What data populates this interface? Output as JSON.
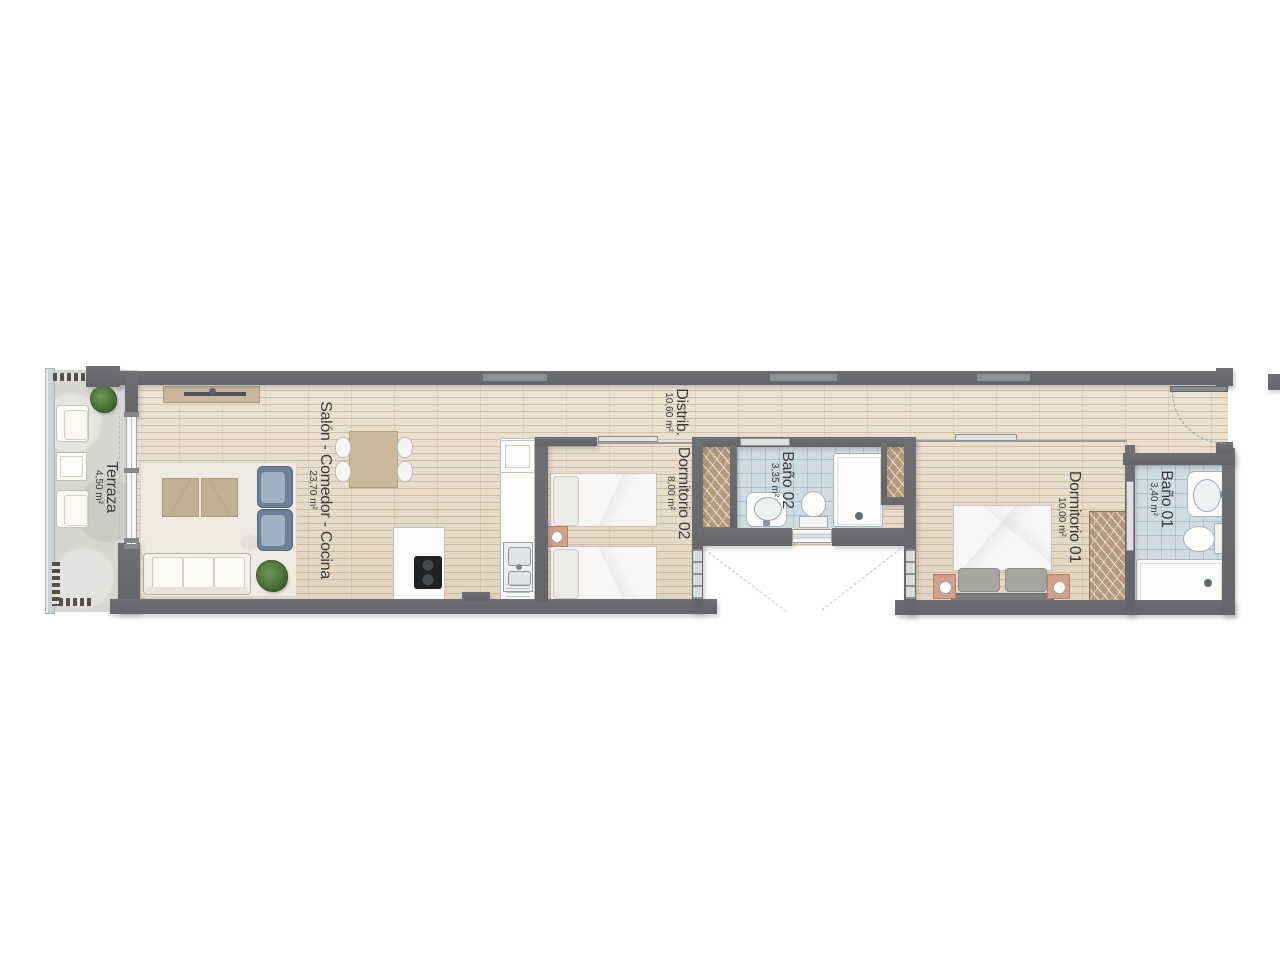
{
  "rooms": [
    {
      "label": "Terraza",
      "area": "4,50 m²"
    },
    {
      "label": "Salón - Comedor - Cocina",
      "area": "23,70 m²"
    },
    {
      "label": "Distrib.",
      "area": "10,60 m²"
    },
    {
      "label": "Dormitorio 02",
      "area": "8,00 m²"
    },
    {
      "label": "Baño 02",
      "area": "3,35 m²"
    },
    {
      "label": "Dormitorio 01",
      "area": "10,00 m²"
    },
    {
      "label": "Baño 01",
      "area": "3,40 m²"
    }
  ],
  "colors": {
    "wall": "#67696c",
    "wood_floor": "#e8dbc7",
    "bathroom_tile": "#cfdde3",
    "terrace_floor": "#d6d6d2",
    "wardrobe": "#b49a7a",
    "accent_salmon": "#d0a08c",
    "accent_blue": "#7e93a7",
    "label_text": "#3a3a3a"
  }
}
